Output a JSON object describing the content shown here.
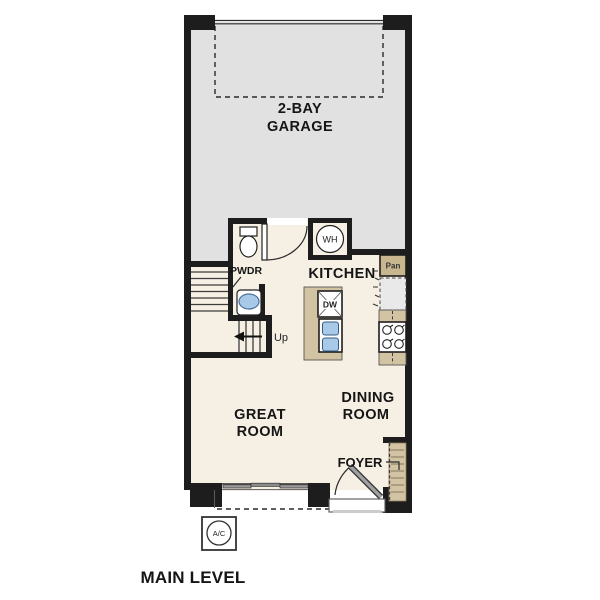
{
  "title": {
    "text": "MAIN LEVEL"
  },
  "rooms": {
    "garage": {
      "line1": "2-BAY",
      "line2": "GARAGE"
    },
    "kitchen": {
      "label": "KITCHEN"
    },
    "powder": {
      "label": "PWDR"
    },
    "great_room": {
      "line1": "GREAT",
      "line2": "ROOM"
    },
    "dining_room": {
      "line1": "DINING",
      "line2": "ROOM"
    },
    "foyer": {
      "label": "FOYER"
    }
  },
  "labels": {
    "water_heater": "WH",
    "pantry": "Pan",
    "dishwasher": "DW",
    "stairs_up": "Up",
    "ac_unit": "A/C"
  },
  "colors": {
    "wall": "#1d1d1d",
    "garage_floor": "#e1e1e1",
    "floor": "#f6efe4",
    "counter": "#d2c3a3",
    "pantry_fill": "#c7b68e",
    "closet_fill": "#d2c3a3",
    "sink_blue": "#a9c9e9",
    "appliance_gray": "#e9e9e9",
    "door_leaf_gray": "#a0a0a0"
  }
}
